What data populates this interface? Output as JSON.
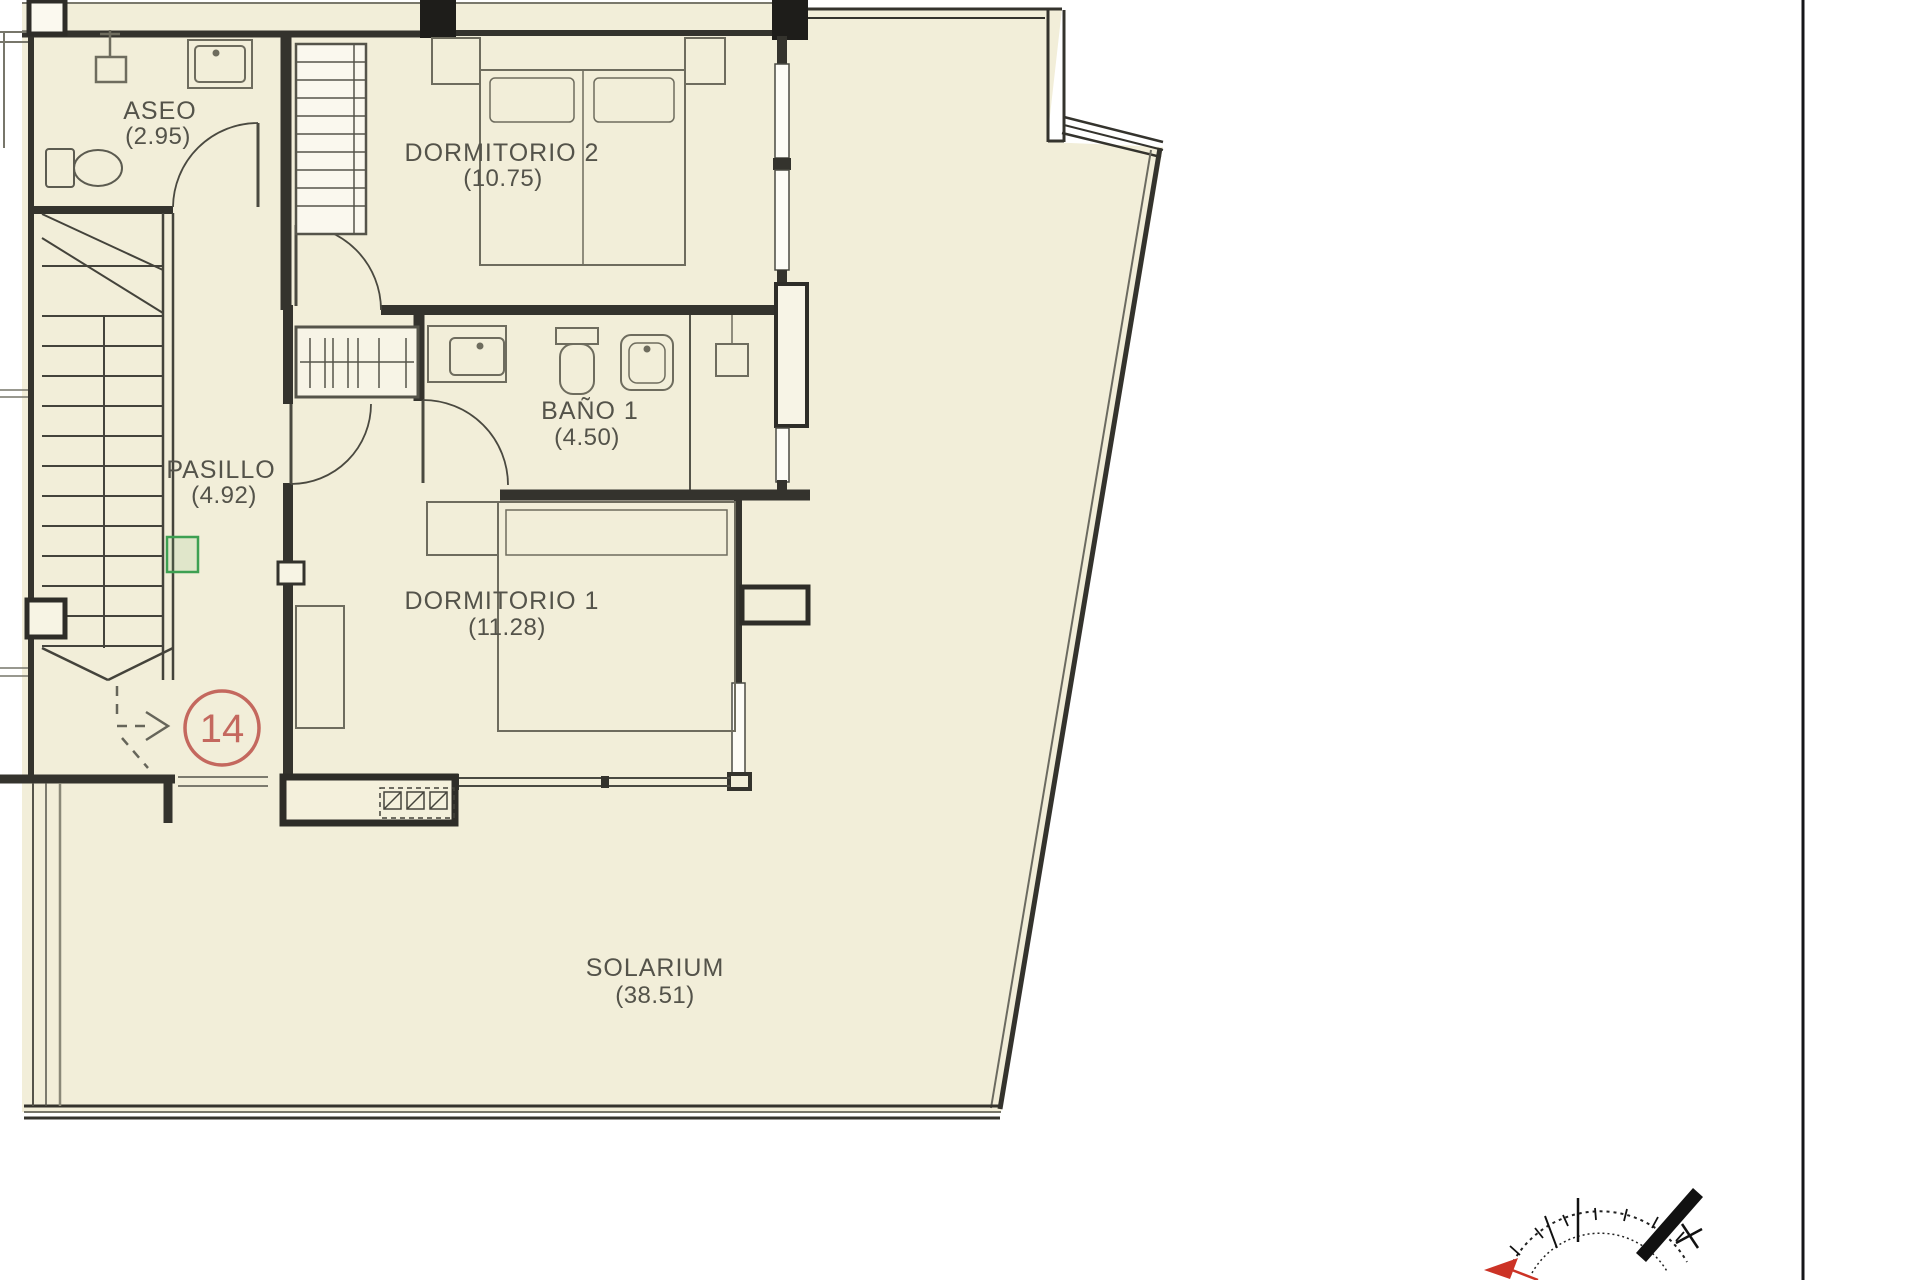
{
  "document": {
    "kind": "architectural floor plan",
    "floor": "upper floor with solarium"
  },
  "rooms": [
    {
      "id": "aseo",
      "name": "ASEO",
      "area": "(2.95)"
    },
    {
      "id": "dormitorio-2",
      "name": "DORMITORIO 2",
      "area": "(10.75)"
    },
    {
      "id": "bano-1",
      "name": "BAÑO 1",
      "area": "(4.50)"
    },
    {
      "id": "pasillo",
      "name": "PASILLO",
      "area": "(4.92)"
    },
    {
      "id": "dormitorio-1",
      "name": "DORMITORIO 1",
      "area": "(11.28)"
    },
    {
      "id": "solarium",
      "name": "SOLARIUM",
      "area": "(38.51)"
    }
  ],
  "unit_badge": {
    "number": "14"
  },
  "colors": {
    "floor_fill": "#f2eed9",
    "wall": "#34332d",
    "furniture_line": "#6e6c5e",
    "badge_red": "#c4685e",
    "highlight_green": "#3da052",
    "compass_red": "#cc3326"
  },
  "icons": [
    "compass-rose-icon",
    "north-needle-icon",
    "staircase",
    "stairs-direction-arrow"
  ]
}
